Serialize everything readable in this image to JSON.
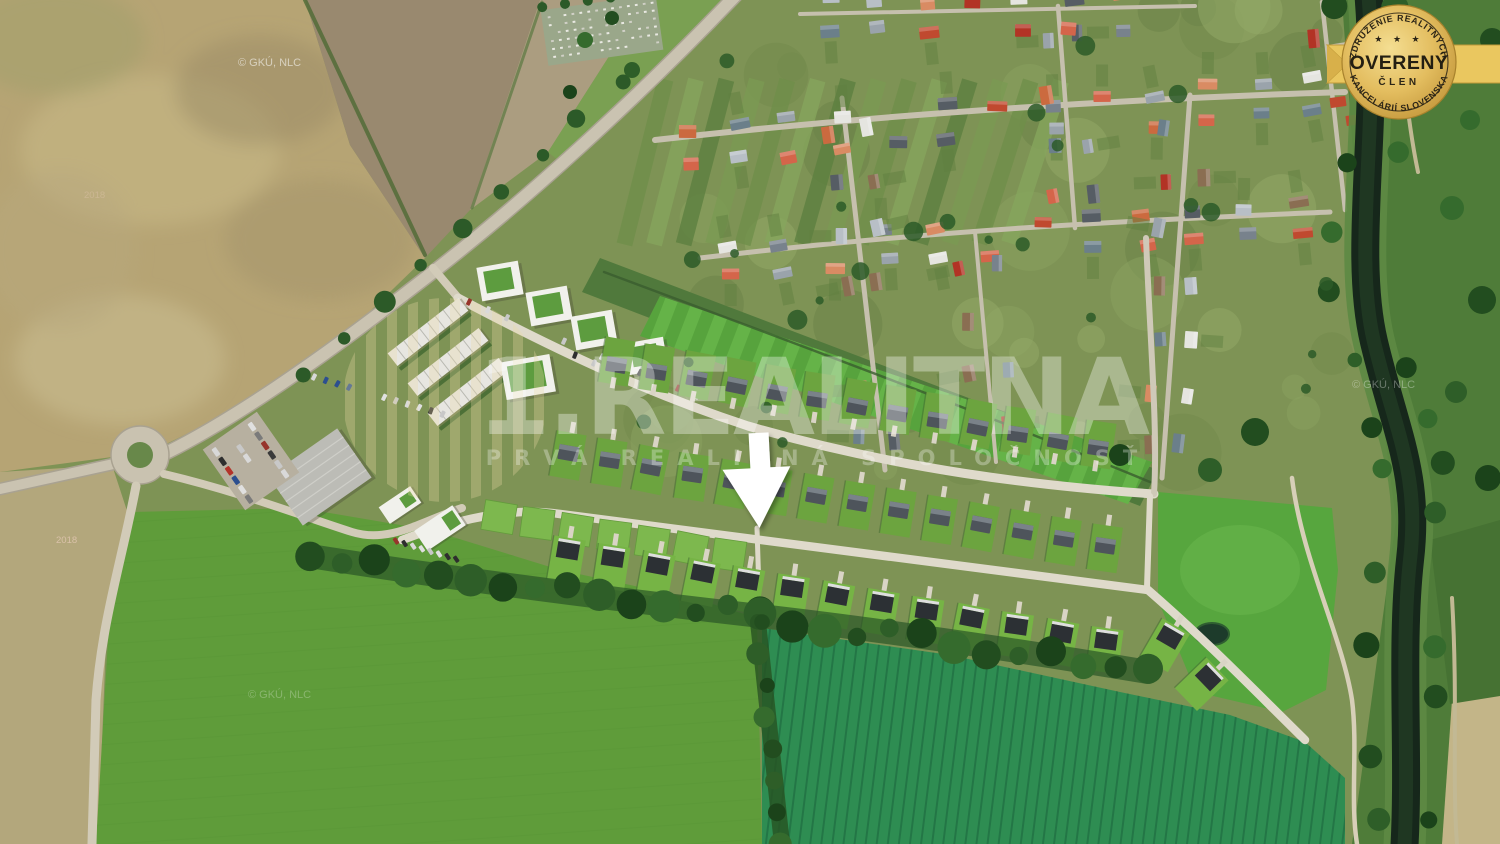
{
  "watermark": {
    "brand": "1.REALITNA",
    "tagline": "PRVÁ REALITNÁ SPOLOČNOSŤ"
  },
  "badge": {
    "arc_top": "ZDRUŽENIE REALITNÝCH",
    "stars": "★ ★ ★",
    "title": "OVERENÝ",
    "subtitle": "ČLEN",
    "arc_bottom": "KANCELÁRIÍ SLOVENSKA",
    "colors": {
      "gold": "#e8c766",
      "gold_dark": "#bd9538",
      "ink": "#2b2416"
    }
  },
  "credits": {
    "text": "© GKÚ, NLC",
    "year": "2018"
  },
  "marker": {
    "kind": "down-arrow",
    "color": "#ffffff"
  },
  "scene": {
    "colors": {
      "village_green": "#7e9355",
      "field_tan": "#b6a474",
      "field_plowed": "#99896f",
      "field_green_left": "#5f9c3a",
      "field_green_right": "#2e8d52",
      "field_green_east": "#57a63e",
      "canal": "#16271b",
      "road": "#cac3b1",
      "dev_street": "#dfdacb",
      "lawn": "#6ca43f",
      "roof_dark": "#4e545b",
      "roof_modern": "#2c3034",
      "tree": "#2a5526",
      "apartment": "#f1f1ec",
      "apartment_roof": "#5d9c3f"
    }
  }
}
